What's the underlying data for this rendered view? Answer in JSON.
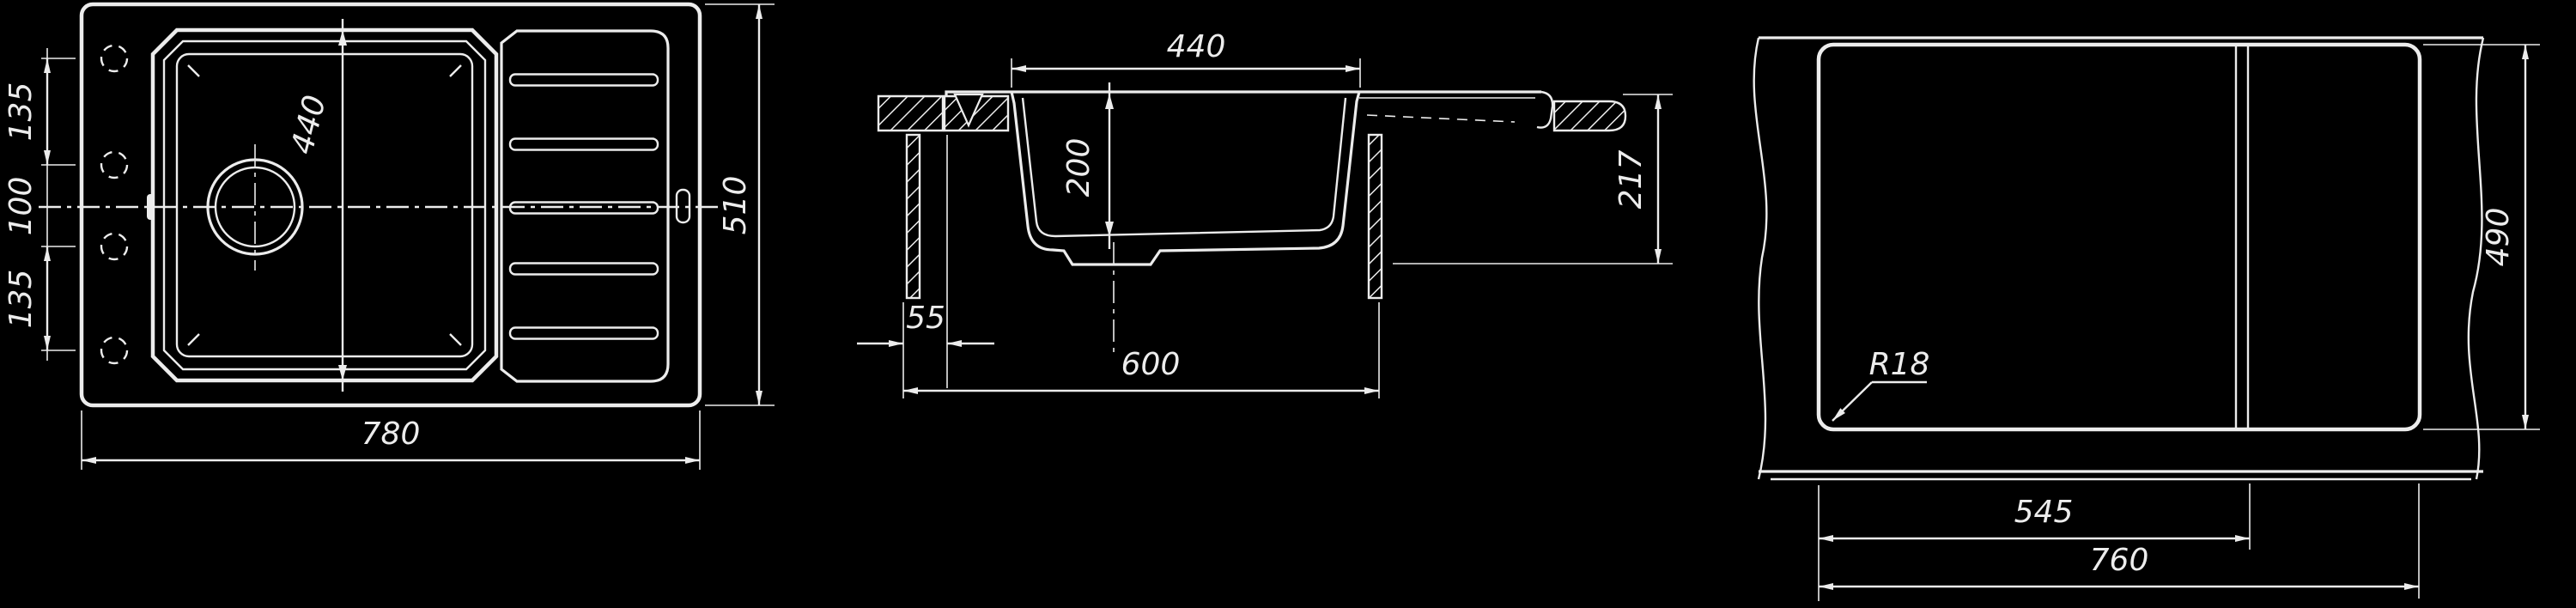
{
  "drawing": {
    "type": "technical-drawing",
    "subject": "kitchen sink with drainboard - three orthographic views",
    "colors": {
      "background": "#000000",
      "line": "#ececec"
    },
    "views": {
      "top": {
        "label": "top-view",
        "overall_width": "780",
        "overall_depth": "510",
        "bowl_length": "440",
        "hole_spacing_top": "135",
        "hole_spacing_middle": "100",
        "hole_spacing_bottom": "135"
      },
      "section": {
        "label": "section-view",
        "bowl_width": "440",
        "bowl_depth": "200",
        "total_height": "217",
        "side_offset": "55",
        "cabinet_width": "600"
      },
      "cutout": {
        "label": "cutout-template-view",
        "corner_radius": "R18",
        "partition_offset": "545",
        "cutout_width": "760",
        "cutout_height": "490"
      }
    }
  }
}
